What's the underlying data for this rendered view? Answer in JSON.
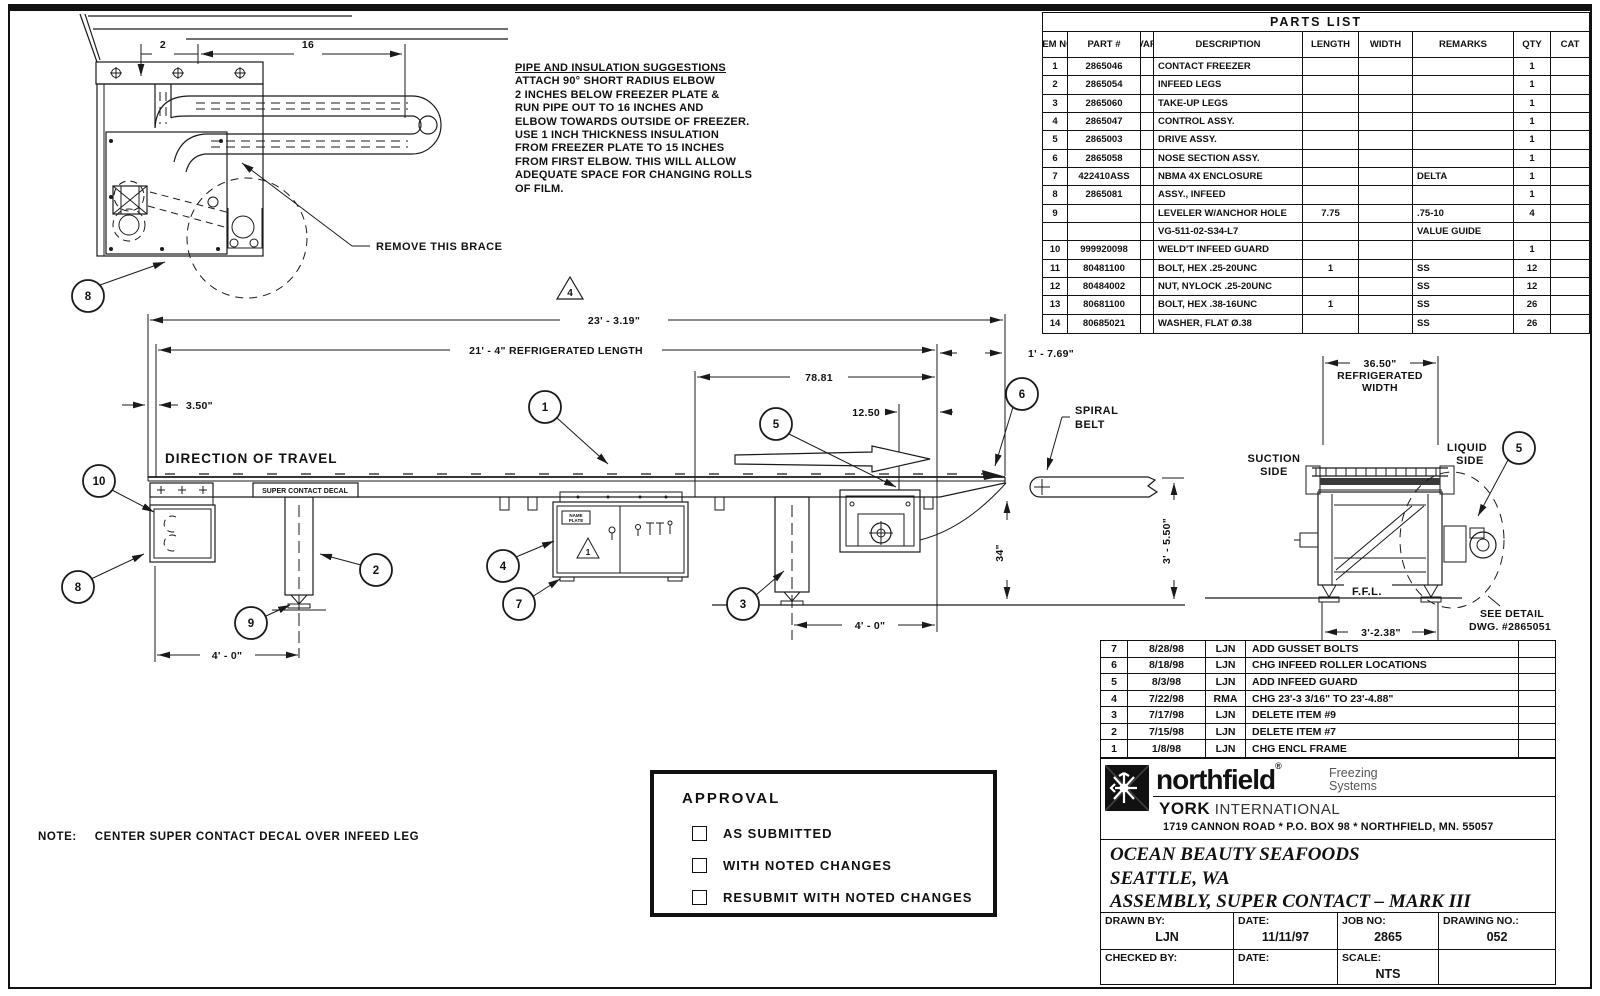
{
  "parts_list": {
    "title": "PARTS LIST",
    "headers": {
      "item": "ITEM NO.",
      "part": "PART #",
      "var": "VAR",
      "description": "DESCRIPTION",
      "length": "LENGTH",
      "width": "WIDTH",
      "remarks": "REMARKS",
      "qty": "QTY",
      "cat": "CAT"
    },
    "rows": [
      {
        "item": "1",
        "part": "2865046",
        "var": "",
        "description": "CONTACT FREEZER",
        "length": "",
        "width": "",
        "remarks": "",
        "qty": "1",
        "cat": ""
      },
      {
        "item": "2",
        "part": "2865054",
        "var": "",
        "description": "INFEED LEGS",
        "length": "",
        "width": "",
        "remarks": "",
        "qty": "1",
        "cat": ""
      },
      {
        "item": "3",
        "part": "2865060",
        "var": "",
        "description": "TAKE-UP LEGS",
        "length": "",
        "width": "",
        "remarks": "",
        "qty": "1",
        "cat": ""
      },
      {
        "item": "4",
        "part": "2865047",
        "var": "",
        "description": "CONTROL ASSY.",
        "length": "",
        "width": "",
        "remarks": "",
        "qty": "1",
        "cat": ""
      },
      {
        "item": "5",
        "part": "2865003",
        "var": "",
        "description": "DRIVE ASSY.",
        "length": "",
        "width": "",
        "remarks": "",
        "qty": "1",
        "cat": ""
      },
      {
        "item": "6",
        "part": "2865058",
        "var": "",
        "description": "NOSE SECTION ASSY.",
        "length": "",
        "width": "",
        "remarks": "",
        "qty": "1",
        "cat": ""
      },
      {
        "item": "7",
        "part": "422410ASS",
        "var": "",
        "description": "NBMA 4X ENCLOSURE",
        "length": "",
        "width": "",
        "remarks": "DELTA",
        "qty": "1",
        "cat": ""
      },
      {
        "item": "8",
        "part": "2865081",
        "var": "",
        "description": "ASSY., INFEED",
        "length": "",
        "width": "",
        "remarks": "",
        "qty": "1",
        "cat": ""
      },
      {
        "item": "9",
        "part": "",
        "var": "",
        "description": "LEVELER W/ANCHOR HOLE",
        "length": "7.75",
        "width": "",
        "remarks": ".75-10",
        "qty": "4",
        "cat": ""
      },
      {
        "item": "",
        "part": "",
        "var": "",
        "description": "VG-511-02-S34-L7",
        "length": "",
        "width": "",
        "remarks": "VALUE GUIDE",
        "qty": "",
        "cat": ""
      },
      {
        "item": "10",
        "part": "999920098",
        "var": "",
        "description": "WELD'T INFEED GUARD",
        "length": "",
        "width": "",
        "remarks": "",
        "qty": "1",
        "cat": ""
      },
      {
        "item": "11",
        "part": "80481100",
        "var": "",
        "description": "BOLT, HEX .25-20UNC",
        "length": "1",
        "width": "",
        "remarks": "SS",
        "qty": "12",
        "cat": ""
      },
      {
        "item": "12",
        "part": "80484002",
        "var": "",
        "description": "NUT, NYLOCK .25-20UNC",
        "length": "",
        "width": "",
        "remarks": "SS",
        "qty": "12",
        "cat": ""
      },
      {
        "item": "13",
        "part": "80681100",
        "var": "",
        "description": "BOLT, HEX .38-16UNC",
        "length": "1",
        "width": "",
        "remarks": "SS",
        "qty": "26",
        "cat": ""
      },
      {
        "item": "14",
        "part": "80685021",
        "var": "",
        "description": "WASHER, FLAT Ø.38",
        "length": "",
        "width": "",
        "remarks": "SS",
        "qty": "26",
        "cat": ""
      }
    ]
  },
  "pipe_note": {
    "title": "PIPE AND INSULATION SUGGESTIONS",
    "lines": [
      "ATTACH 90° SHORT RADIUS ELBOW",
      "2 INCHES BELOW FREEZER PLATE &",
      "RUN PIPE OUT TO 16 INCHES AND",
      "ELBOW TOWARDS OUTSIDE OF FREEZER.",
      "USE 1 INCH THICKNESS INSULATION",
      "FROM FREEZER PLATE TO 15 INCHES",
      "FROM FIRST ELBOW. THIS WILL ALLOW",
      "ADEQUATE SPACE FOR CHANGING ROLLS",
      "OF FILM."
    ]
  },
  "detail_view": {
    "dim_2": "2",
    "dim_16": "16",
    "balloon_8": "8",
    "brace_note": "REMOVE THIS BRACE"
  },
  "main_view": {
    "dim_overall": "23' - 3.19\"",
    "dim_refrigerated": "21' - 4\"  REFRIGERATED LENGTH",
    "dim_7881": "78.81",
    "dim_1250": "12.50",
    "dim_350": "3.50\"",
    "dim_1769": "1' - 7.69\"",
    "dim_34": "34\"",
    "dim_3550": "3' - 5.50\"",
    "dim_infeed_span": "4' - 0\"",
    "dim_takeup_span": "4' - 0\"",
    "direction_label": "DIRECTION OF TRAVEL",
    "decal_label": "SUPER CONTACT DECAL",
    "spiral_line1": "SPIRAL",
    "spiral_line2": "BELT",
    "rev_flag": "4",
    "warn_flag": "1",
    "name_plate1": "NAME",
    "name_plate2": "PLATE",
    "balloons": {
      "b1": "1",
      "b2": "2",
      "b3": "3",
      "b4": "4",
      "b5": "5",
      "b6": "6",
      "b7": "7",
      "b8": "8",
      "b9": "9",
      "b10": "10"
    }
  },
  "end_view": {
    "dim_width": "36.50\"",
    "width_label1": "REFRIGERATED",
    "width_label2": "WIDTH",
    "suction1": "SUCTION",
    "suction2": "SIDE",
    "liquid1": "LIQUID",
    "liquid2": "SIDE",
    "balloon_5": "5",
    "ffl": "F.F.L.",
    "dim_base": "3'-2.38\"",
    "detail_note1": "SEE DETAIL",
    "detail_note2": "DWG. #2865051"
  },
  "revisions": [
    {
      "rev": "7",
      "date": "8/28/98",
      "by": "LJN",
      "desc": "ADD GUSSET BOLTS"
    },
    {
      "rev": "6",
      "date": "8/18/98",
      "by": "LJN",
      "desc": "CHG INFEED ROLLER LOCATIONS"
    },
    {
      "rev": "5",
      "date": "8/3/98",
      "by": "LJN",
      "desc": "ADD INFEED GUARD"
    },
    {
      "rev": "4",
      "date": "7/22/98",
      "by": "RMA",
      "desc": "CHG 23'-3 3/16\" TO 23'-4.88\""
    },
    {
      "rev": "3",
      "date": "7/17/98",
      "by": "LJN",
      "desc": "DELETE ITEM #9"
    },
    {
      "rev": "2",
      "date": "7/15/98",
      "by": "LJN",
      "desc": "DELETE ITEM #7"
    },
    {
      "rev": "1",
      "date": "1/8/98",
      "by": "LJN",
      "desc": "CHG ENCL FRAME"
    }
  ],
  "brand": {
    "name": "northfield",
    "reg": "®",
    "tag1": "Freezing",
    "tag2": "Systems",
    "company_bold": "YORK",
    "company_rest": " INTERNATIONAL",
    "address": "1719 CANNON ROAD * P.O. BOX 98 * NORTHFIELD, MN. 55057"
  },
  "title_block": {
    "customer": "OCEAN BEAUTY SEAFOODS",
    "location": "SEATTLE, WA",
    "assembly": "ASSEMBLY, SUPER CONTACT – MARK III",
    "drawn_by_label": "DRAWN BY:",
    "drawn_by": "LJN",
    "date1_label": "DATE:",
    "date1": "11/11/97",
    "job_label": "JOB NO:",
    "job": "2865",
    "drawing_label": "DRAWING NO.:",
    "drawing": "052",
    "checked_label": "CHECKED BY:",
    "checked": "",
    "date2_label": "DATE:",
    "date2": "",
    "scale_label": "SCALE:",
    "scale": "NTS",
    "blank": ""
  },
  "approval": {
    "title": "APPROVAL",
    "options": [
      "AS SUBMITTED",
      "WITH NOTED CHANGES",
      "RESUBMIT WITH NOTED CHANGES"
    ]
  },
  "note": {
    "label": "NOTE:",
    "text": "CENTER SUPER CONTACT DECAL OVER INFEED LEG"
  }
}
